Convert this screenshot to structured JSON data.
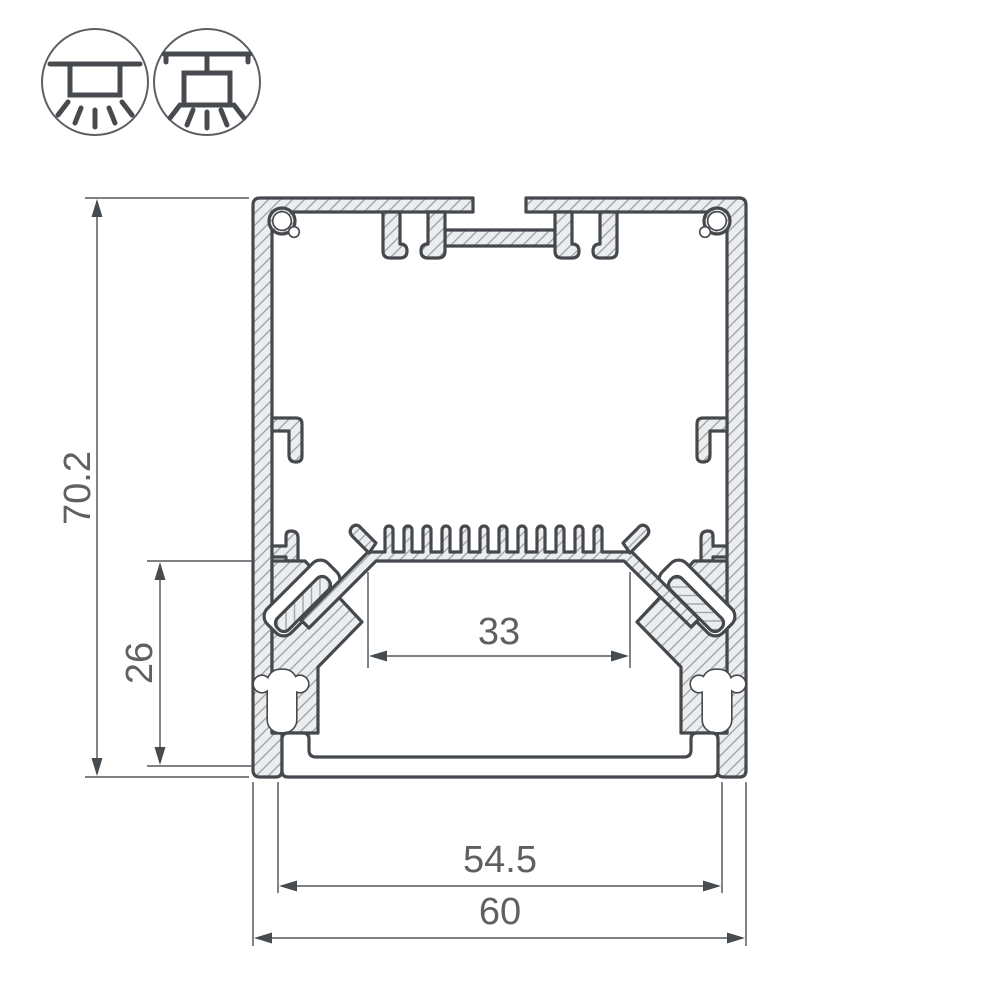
{
  "drawing": {
    "dimensions": {
      "overall_height": "70.2",
      "mount_depth": "26",
      "led_shelf_width": "33",
      "diffuser_width": "54.5",
      "overall_width": "60"
    },
    "icons": [
      {
        "name": "surface-mount-luminaire-icon"
      },
      {
        "name": "pendant-mount-luminaire-icon"
      }
    ],
    "colors": {
      "background": "#ffffff",
      "profile_outline": "#45494d",
      "profile_fill": "#ecedee",
      "hatch_line": "#a2a6a8",
      "dimension_line": "#6b7073",
      "arrow": "#464b4f",
      "label_text": "#5d6163"
    }
  }
}
